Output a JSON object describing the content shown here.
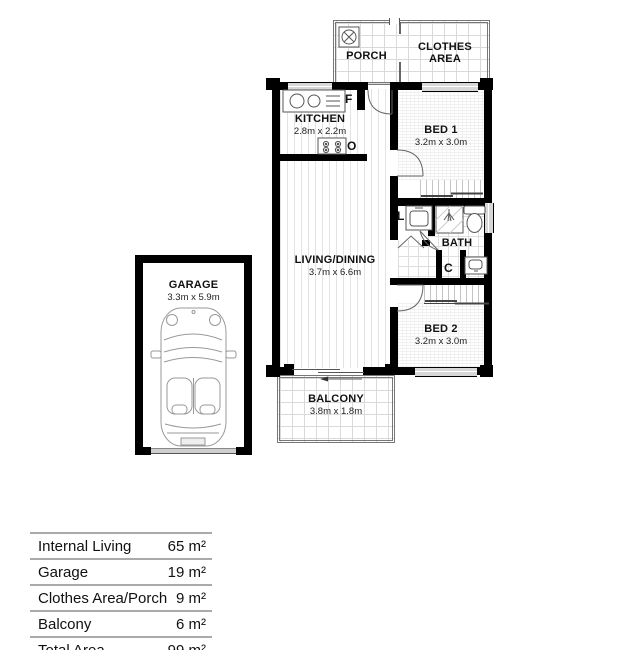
{
  "plan": {
    "porch": {
      "name": "PORCH"
    },
    "clothes": {
      "name": "CLOTHES\nAREA"
    },
    "kitchen": {
      "name": "KITCHEN",
      "dims": "2.8m x 2.2m",
      "fridge_label": "F",
      "oven_label": "O"
    },
    "bed1": {
      "name": "BED 1",
      "dims": "3.2m x 3.0m"
    },
    "living": {
      "name": "LIVING/DINING",
      "dims": "3.7m x 6.6m"
    },
    "bath": {
      "name": "BATH",
      "laundry_label": "L",
      "cupboard_label": "C"
    },
    "bed2": {
      "name": "BED 2",
      "dims": "3.2m x 3.0m"
    },
    "balcony": {
      "name": "BALCONY",
      "dims": "3.8m x 1.8m"
    },
    "garage": {
      "name": "GARAGE",
      "dims": "3.3m x 5.9m"
    }
  },
  "area_table": {
    "rows": [
      {
        "label": "Internal Living",
        "value": "65 m²"
      },
      {
        "label": "Garage",
        "value": "19 m²"
      },
      {
        "label": "Clothes Area/Porch",
        "value": "9 m²"
      },
      {
        "label": "Balcony",
        "value": "6 m²"
      },
      {
        "label": "Total Area",
        "value": "99 m²"
      }
    ]
  },
  "colors": {
    "wall": "#000000",
    "window_fill": "#d7d7d7",
    "texture_line": "#dcdcdc",
    "table_rule": "#aaaaaa",
    "text": "#111111"
  }
}
